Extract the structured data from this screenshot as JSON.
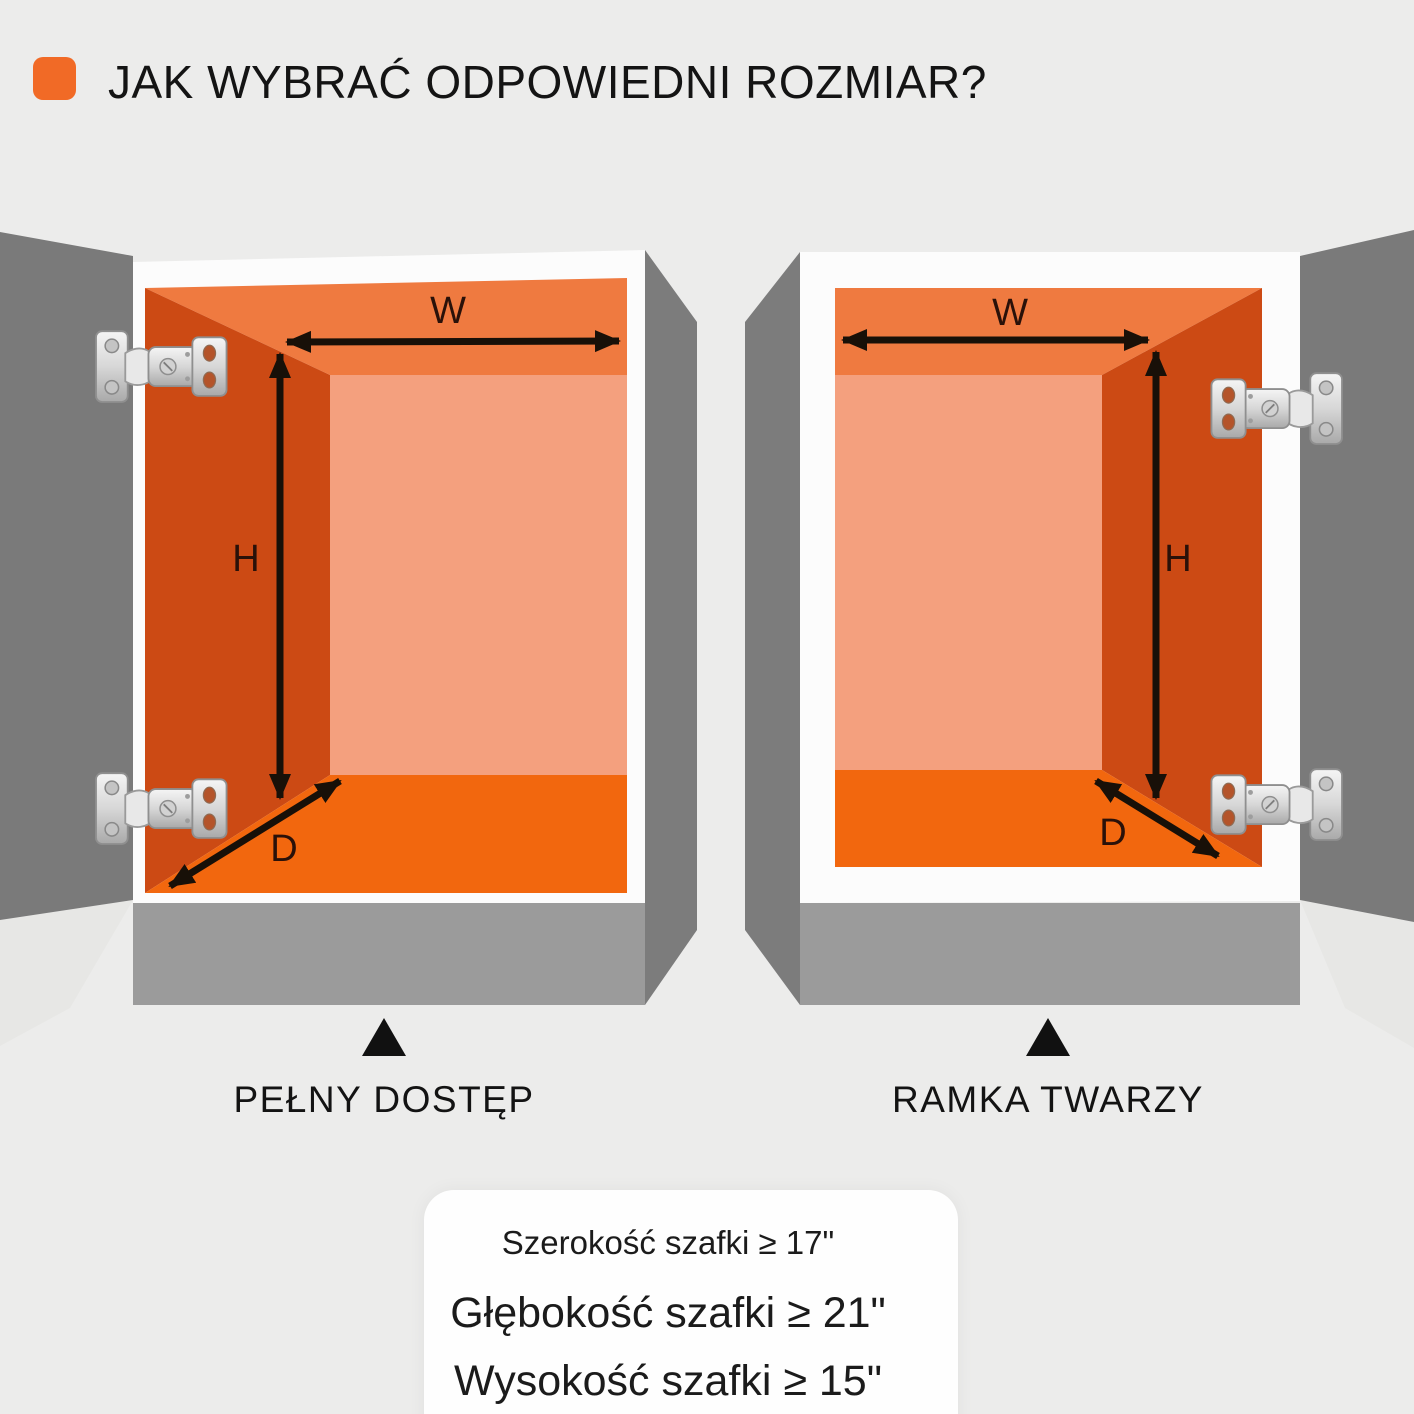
{
  "title": {
    "text": "JAK WYBRAĆ ODPOWIEDNI ROZMIAR?"
  },
  "cabinets": {
    "left": {
      "label": "PEŁNY DOSTĘP",
      "width_label": "W",
      "height_label": "H",
      "depth_label": "D"
    },
    "right": {
      "label": "RAMKA TWARZY",
      "width_label": "W",
      "height_label": "H",
      "depth_label": "D"
    }
  },
  "specs": {
    "line1": "Szerokość szafki ≥ 17\"",
    "line2": "Głębokość szafki ≥ 21\"",
    "line3": "Wysokość szafki ≥ 15\""
  },
  "icons": {
    "hinge": "hinge-icon",
    "pointer": "up-triangle-icon",
    "bullet": "title-bullet-icon"
  },
  "colors": {
    "background": "#ECECEB",
    "accent_orange": "#F16A26",
    "interior_ceiling": "#EF7A40",
    "interior_wall_dark": "#CC4A14",
    "interior_back": "#F4A07E",
    "interior_floor": "#F2670E",
    "door_gray": "#7A7A7A",
    "base_gray": "#9B9B9B",
    "cabinet_white": "#FCFCFC",
    "text_dark": "#141414"
  }
}
